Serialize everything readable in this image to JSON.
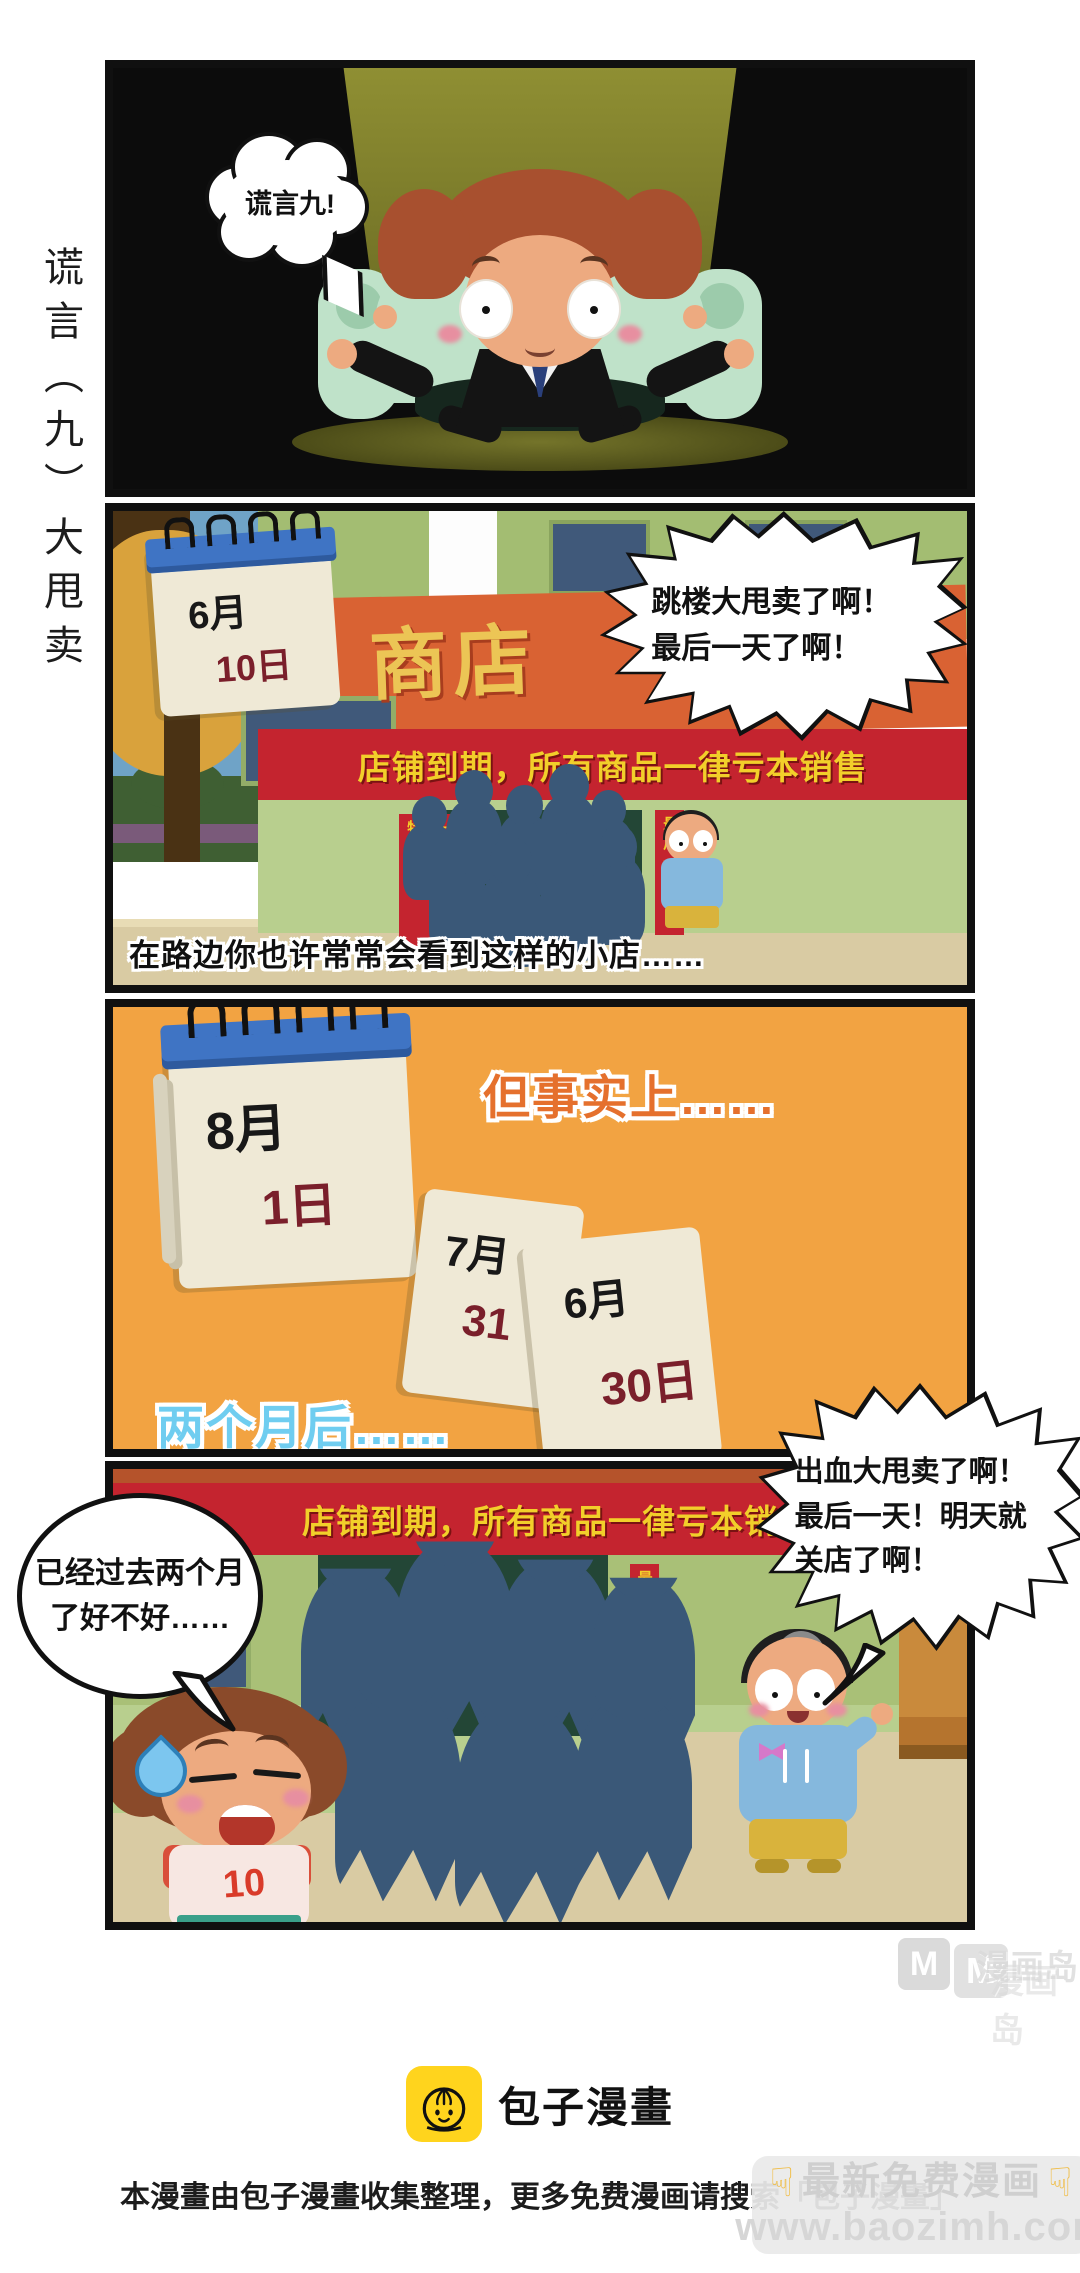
{
  "side_title": "谎言（九）大甩卖",
  "comic": {
    "panel1": {
      "bubble": "谎言九!"
    },
    "panel2": {
      "calendar": {
        "month": "6月",
        "day": "10日"
      },
      "shop_sign": "商店",
      "banner": "店铺到期，所有商品一律亏本销售",
      "burst_line1": "跳楼大甩卖了啊！",
      "burst_line2": "最后一天了啊！",
      "sign_col1": "特价处理",
      "sign_col2": "一件不留",
      "sign_right": "最后一天",
      "caption": "在路边你也许常常会看到这样的小店……"
    },
    "panel3": {
      "heading": "但事实上……",
      "calendar_main": {
        "month": "8月",
        "day": "1日"
      },
      "page_a": {
        "month": "7月",
        "day": "31"
      },
      "page_b": {
        "month": "6月",
        "day": "30日"
      },
      "footing": "两个月后……"
    },
    "panel4": {
      "banner": "店铺到期，所有商品一律亏本销",
      "burst_line1": "出血大甩卖了啊！",
      "burst_line2": "最后一天！明天就",
      "burst_line3": "关店了啊！",
      "ellipse_line1": "已经过去两个月",
      "ellipse_line2": "了好不好……",
      "sign_right": "最后一天",
      "shirt_number": "10"
    }
  },
  "watermarks": {
    "manhuadao": {
      "logo_letter": "M",
      "logo_letter2": "M",
      "name": "漫画岛",
      "name2": "漫画岛"
    },
    "baozi_badge": {
      "hand_icon": "☟",
      "line1": "最新免费漫画",
      "line2": "www.baozimh.com"
    }
  },
  "footer": {
    "brand": "包子漫畫",
    "disclaimer": "本漫畫由包子漫畫收集整理，更多免费漫画请搜索「包子漫畫」"
  },
  "colors": {
    "panel3_bg": "#f2a342",
    "banner_red": "#c4242f",
    "banner_text_yellow": "#f2cf2a",
    "awning_orange": "#d96233",
    "heading_orange": "#e5702d",
    "later_cyan": "#6fcdf0",
    "crowd_navy": "#3a5878",
    "day_red": "#7a1f2b",
    "logo_yellow": "#ffd41d"
  }
}
